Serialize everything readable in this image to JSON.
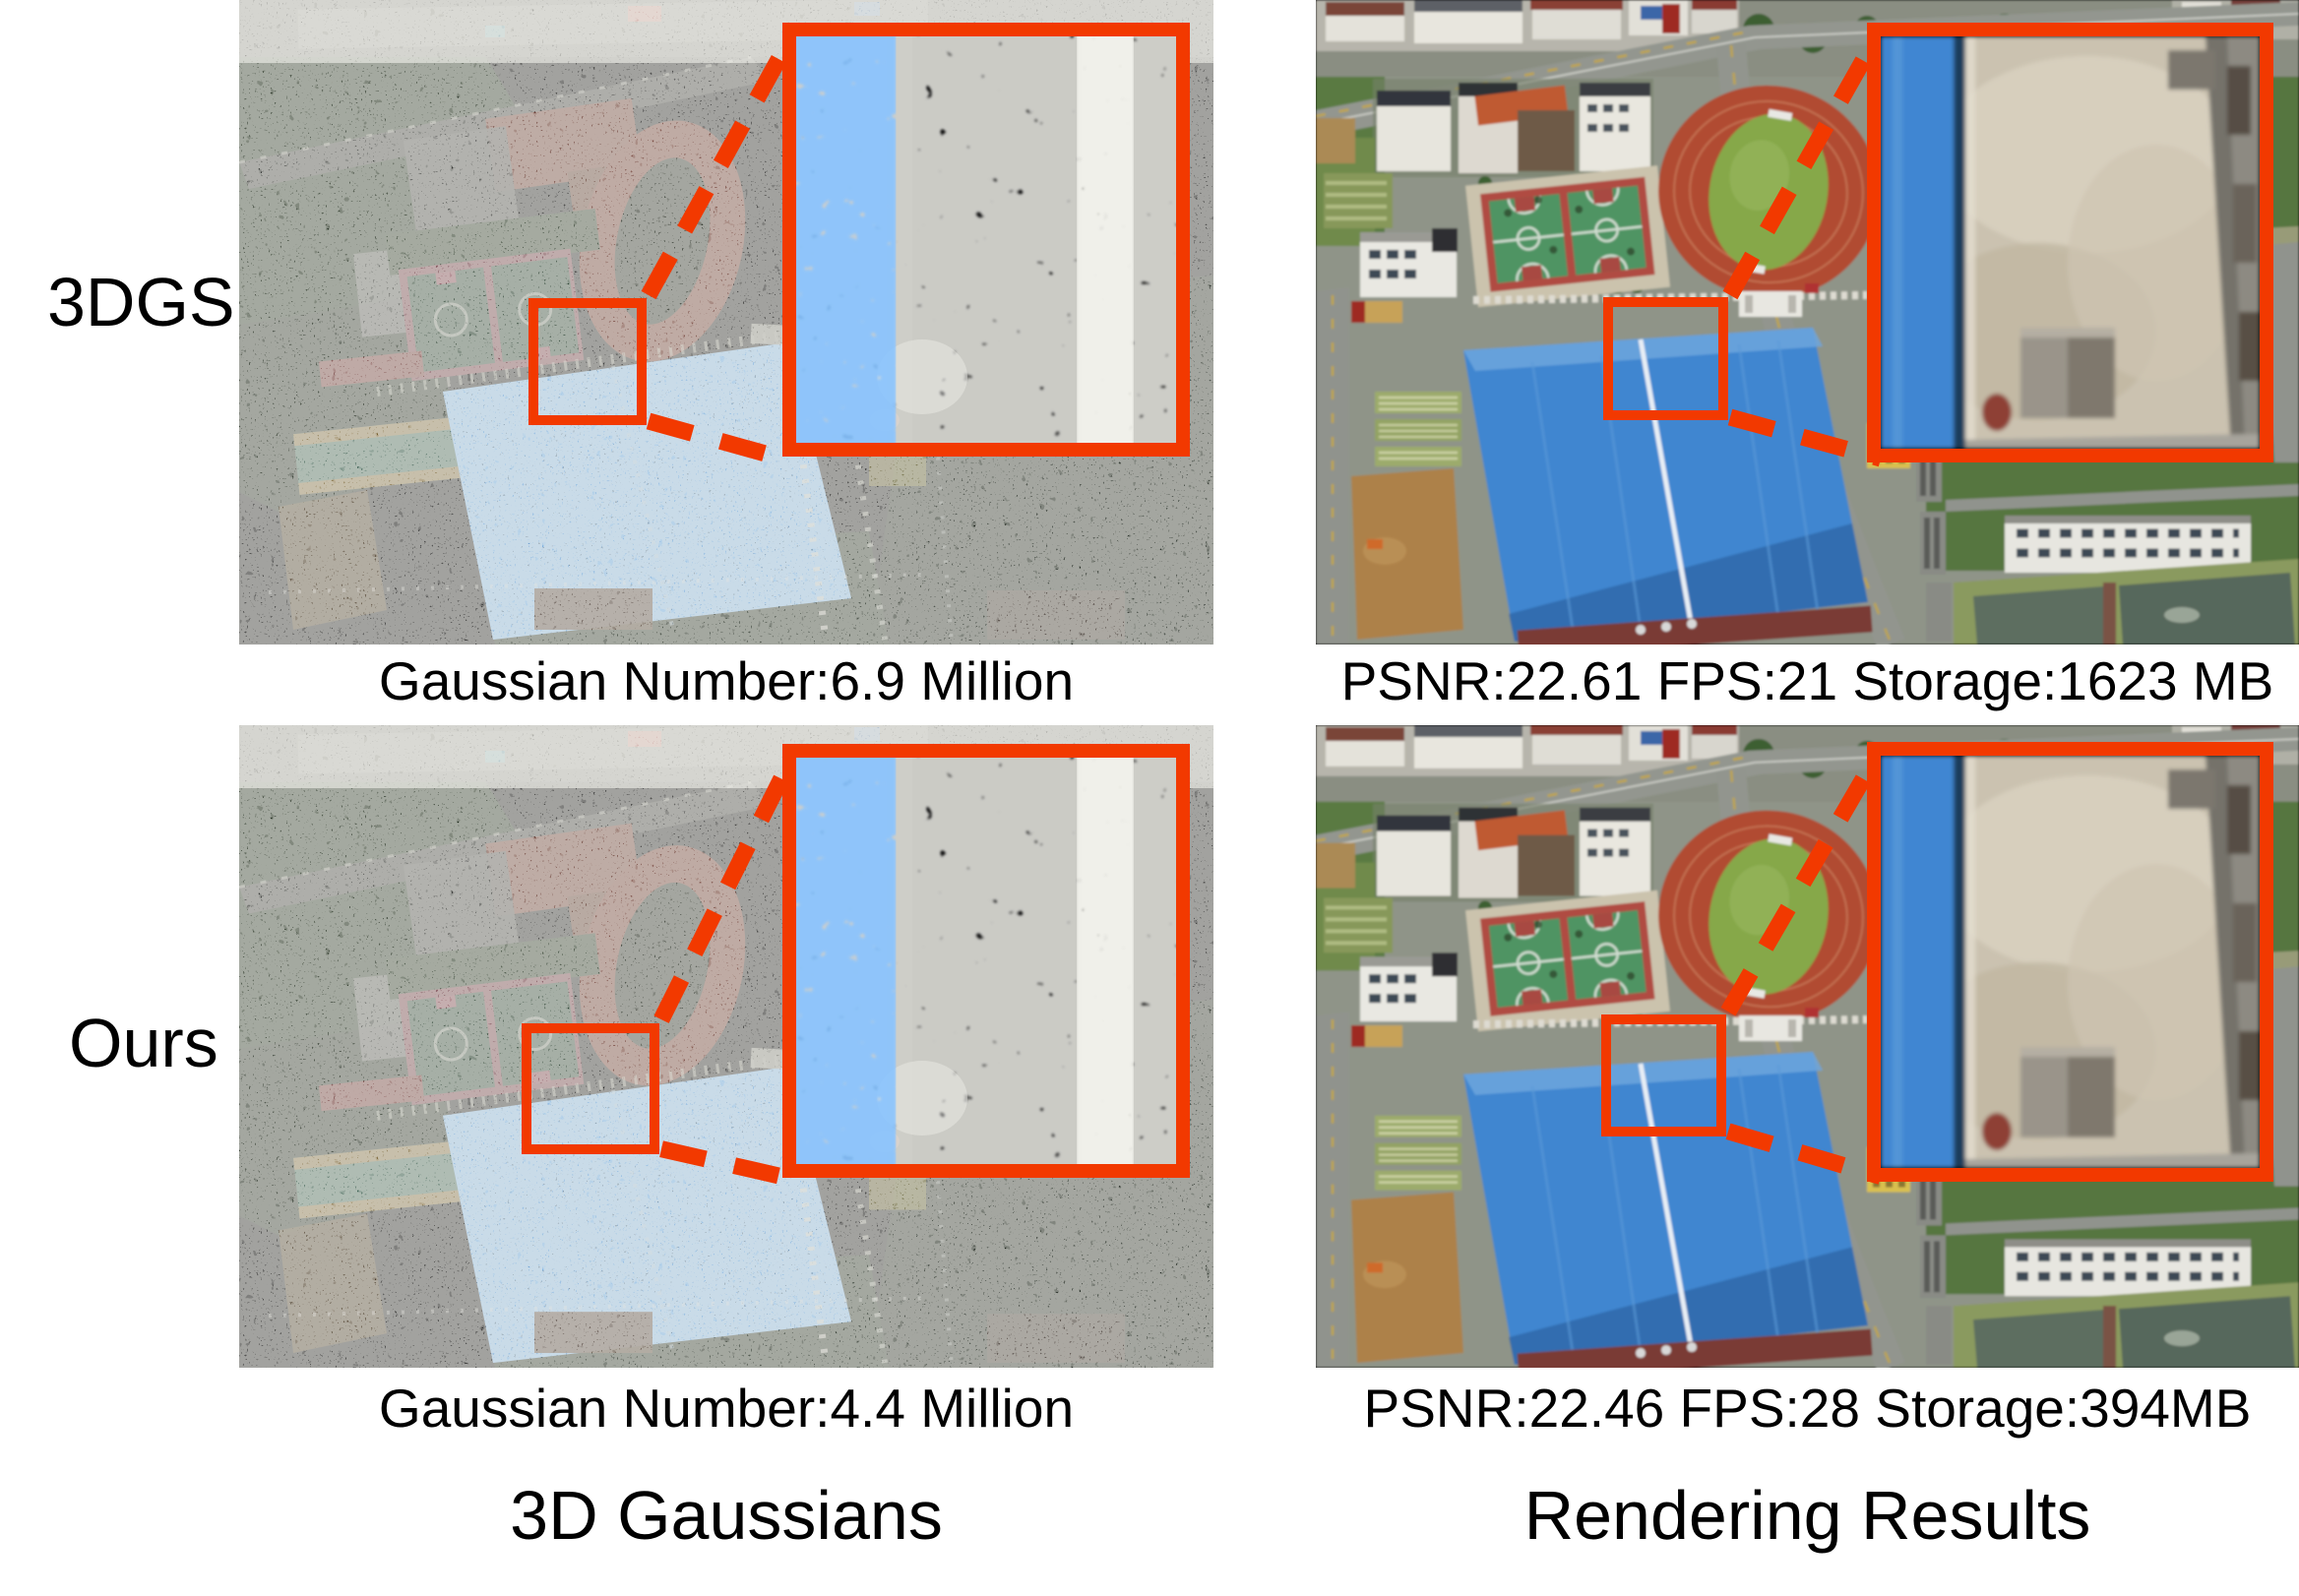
{
  "figure": {
    "highlight_color": "#f23900",
    "rows": [
      {
        "method_label": "3DGS",
        "gaussian_caption": "Gaussian Number:6.9 Million",
        "rendering_caption": "PSNR:22.61 FPS:21 Storage:1623 MB"
      },
      {
        "method_label": "Ours",
        "gaussian_caption": "Gaussian Number:4.4 Million",
        "rendering_caption": "PSNR:22.46 FPS:28 Storage:394MB"
      }
    ],
    "column_titles": {
      "left": "3D Gaussians",
      "right": "Rendering Results"
    }
  }
}
